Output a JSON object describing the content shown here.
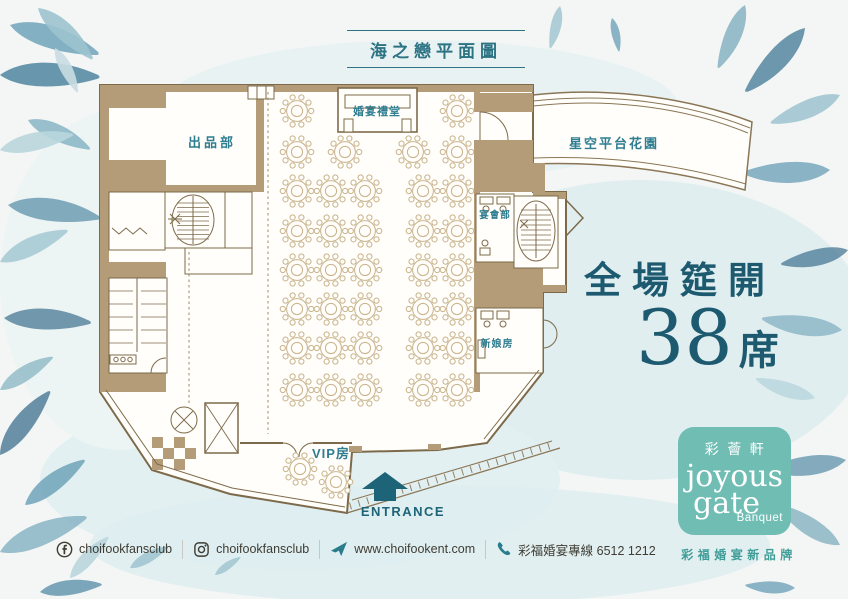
{
  "palette": {
    "accent_teal": "#2c7384",
    "label_teal": "#2e7d90",
    "dark_teal": "#1d5a70",
    "entrance_teal": "#1d6478",
    "logo_teal": "#70bdb4",
    "tagline_teal": "#3f9d98",
    "wall_tan": "#b39c77",
    "wall_line_brown": "#7d6a4b",
    "table_line": "#c8b28a",
    "footer_text": "#3f3d34",
    "footer_icon_teal": "#2a7b8c",
    "leaf_colors": [
      "#6fa3ba",
      "#9cc3cf",
      "#457e9b",
      "#88b4c4",
      "#b9d6dd",
      "#5d92ab",
      "#3c6f8d"
    ]
  },
  "title": {
    "text": "海之戀平面圖"
  },
  "floor_plan": {
    "rooms": [
      {
        "id": "kitchen",
        "label": "出品部",
        "x": 212,
        "y": 147,
        "size": 13,
        "ls": 3
      },
      {
        "id": "ceremony-hall",
        "label": "婚宴禮堂",
        "x": 377,
        "y": 115,
        "size": 11,
        "ls": 1
      },
      {
        "id": "terrace",
        "label": "星空平台花園",
        "x": 614,
        "y": 148,
        "size": 13,
        "ls": 2
      },
      {
        "id": "banquet-office",
        "label": "宴會部",
        "x": 495,
        "y": 218,
        "size": 9.5,
        "ls": 1
      },
      {
        "id": "bridal-room",
        "label": "新娘房",
        "x": 497,
        "y": 347,
        "size": 10,
        "ls": 1
      },
      {
        "id": "vip-room",
        "label": "VIP房",
        "x": 331,
        "y": 458,
        "size": 13,
        "ls": 1
      },
      {
        "id": "entrance",
        "label": "ENTRANCE",
        "x": 403,
        "y": 516,
        "size": 13,
        "ls": 1.5,
        "color": "#1d6478"
      }
    ],
    "tables": [
      [
        297,
        111
      ],
      [
        457,
        111
      ],
      [
        297,
        152
      ],
      [
        345,
        152
      ],
      [
        413,
        152
      ],
      [
        457,
        152
      ],
      [
        297,
        191
      ],
      [
        331,
        191
      ],
      [
        365,
        191
      ],
      [
        423,
        191
      ],
      [
        457,
        191
      ],
      [
        297,
        231
      ],
      [
        331,
        231
      ],
      [
        365,
        231
      ],
      [
        423,
        231
      ],
      [
        457,
        231
      ],
      [
        297,
        270
      ],
      [
        331,
        270
      ],
      [
        365,
        270
      ],
      [
        423,
        270
      ],
      [
        457,
        270
      ],
      [
        297,
        309
      ],
      [
        331,
        309
      ],
      [
        365,
        309
      ],
      [
        423,
        309
      ],
      [
        457,
        309
      ],
      [
        297,
        348
      ],
      [
        331,
        348
      ],
      [
        365,
        348
      ],
      [
        423,
        348
      ],
      [
        457,
        348
      ],
      [
        297,
        390
      ],
      [
        331,
        390
      ],
      [
        365,
        390
      ],
      [
        423,
        390
      ],
      [
        457,
        390
      ],
      [
        300,
        469
      ],
      [
        336,
        482
      ]
    ]
  },
  "seats": {
    "line1": "全場筵開",
    "number": "38",
    "unit": "席"
  },
  "brand": {
    "cn": "彩薈軒",
    "en1": "joyous",
    "en2": "gate",
    "en3": "Banquet",
    "tagline": "彩福婚宴新品牌"
  },
  "footer": {
    "items": [
      {
        "icon": "facebook-icon",
        "text": "choifookfansclub"
      },
      {
        "icon": "instagram-icon",
        "text": "choifookfansclub"
      },
      {
        "icon": "paper-plane-icon",
        "text": "www.choifookent.com"
      },
      {
        "icon": "phone-icon",
        "text": "彩福婚宴專線 6512 1212"
      }
    ]
  }
}
